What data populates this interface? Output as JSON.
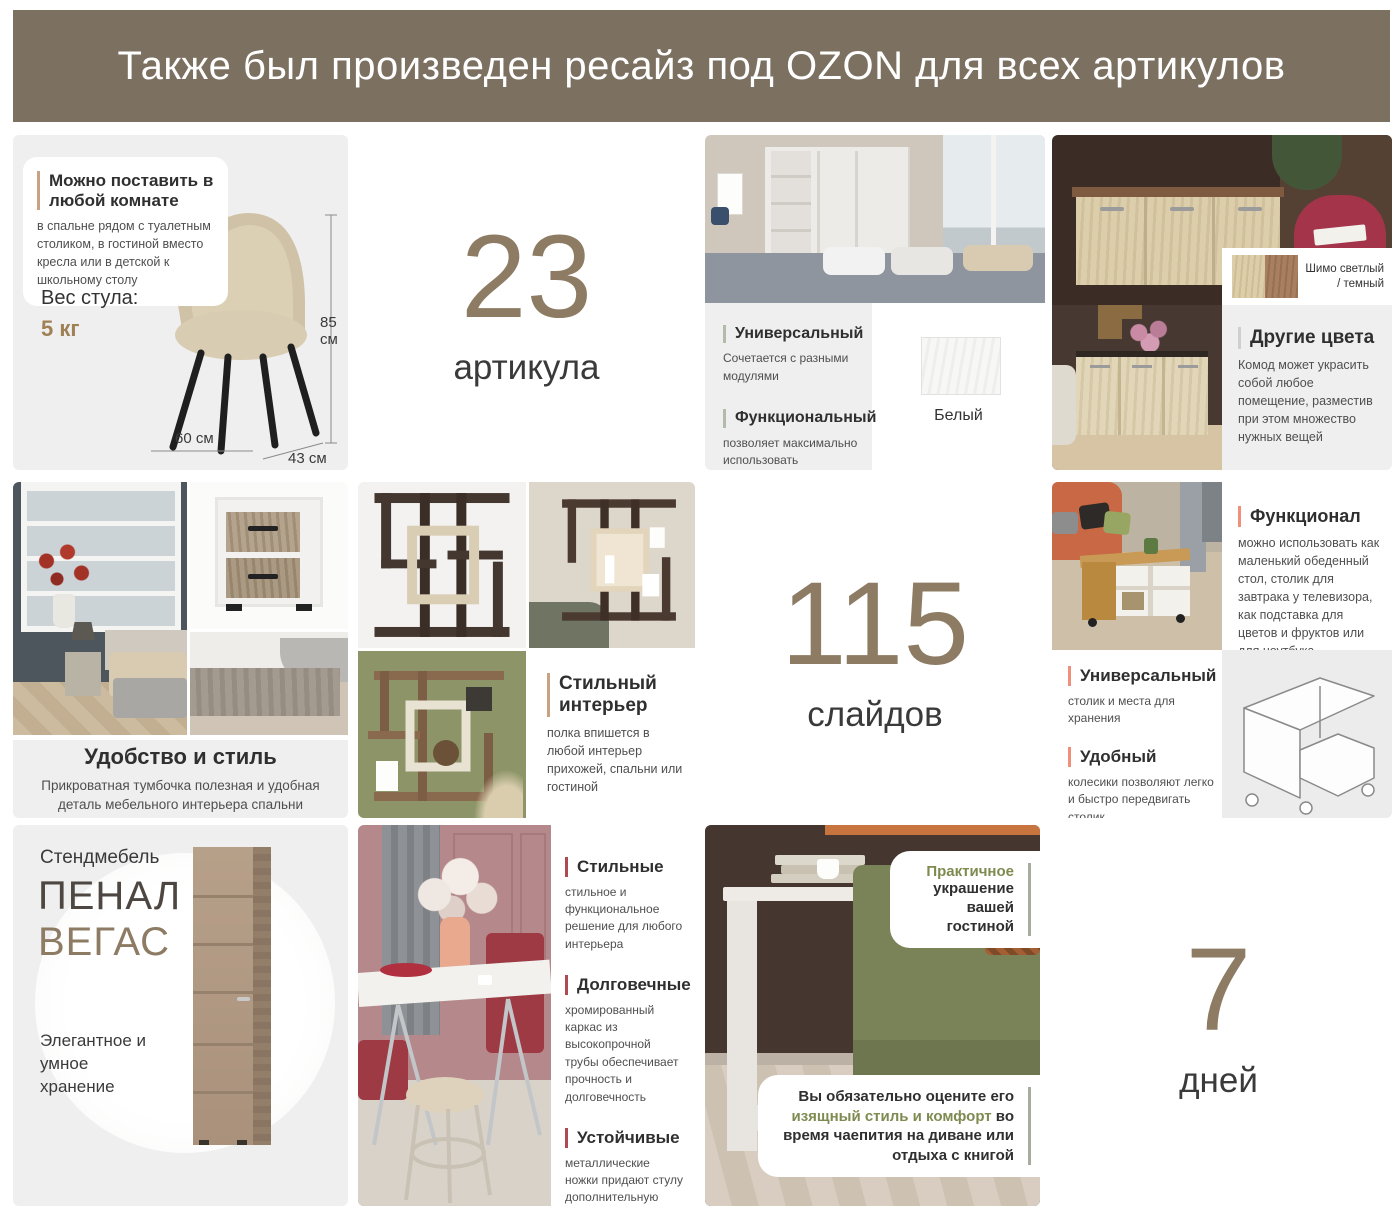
{
  "header": {
    "title": "Также был произведен ресайз под OZON для всех артикулов"
  },
  "stats": {
    "articles": {
      "value": "23",
      "label": "артикула"
    },
    "slides": {
      "value": "115",
      "label": "слайдов"
    },
    "days": {
      "value": "7",
      "label": "дней"
    }
  },
  "chair_card": {
    "feature_title": "Можно поставить в любой комнате",
    "feature_body": "в спальне рядом с туалетным столиком, в гостиной вместо кресла или в детской к школьному столу",
    "weight_label": "Вес стула:",
    "weight_value": "5 кг",
    "dims": {
      "height_num": "85",
      "height_unit": "см",
      "width": "60 см",
      "depth": "43 см"
    }
  },
  "wardrobe_card": {
    "features": [
      {
        "title": "Универсальный",
        "body": "Сочетается с разными модулями"
      },
      {
        "title": "Функциональный",
        "body": "позволяет максимально использовать пространство в комнате"
      }
    ],
    "swatch_label": "Белый"
  },
  "dresser_card": {
    "swatch_label": "Шимо светлый / темный",
    "feature_title": "Другие цвета",
    "feature_body": "Комод может украсить собой любое помещение, разместив при этом множество нужных вещей"
  },
  "nightstand_card": {
    "title": "Удобство и стиль",
    "body": "Прикроватная тумбочка полезная и удобная деталь мебельного интерьера спальни"
  },
  "shelf_card": {
    "feature_title": "Стильный интерьер",
    "feature_body": "полка впишется в любой интерьер прихожей, спальни или гостиной"
  },
  "coffee_table_card": {
    "features": [
      {
        "title": "Функционал",
        "body": "можно использовать как маленький обеденный стол, столик для завтрака у телевизора, как подставка для цветов и фруктов или для ноутбука"
      },
      {
        "title": "Универсальный",
        "body": "столик и места для хранения"
      },
      {
        "title": "Удобный",
        "body": "колесики позволяют легко и быстро передвигать столик"
      }
    ]
  },
  "penal_card": {
    "brand": "Стендмебель",
    "title_line1": "ПЕНАЛ",
    "title_line2": "ВЕГАС",
    "body": "Элегантное и умное хранение"
  },
  "dining_card": {
    "features": [
      {
        "title": "Стильные",
        "body": "стильное и функциональное решение для любого интерьера"
      },
      {
        "title": "Долговечные",
        "body": "хромированный каркас из высокопрочной трубы обеспечивает прочность и долговечность"
      },
      {
        "title": "Устойчивые",
        "body": "металлические ножки придают стулу дополнительную надежность и практичность"
      }
    ]
  },
  "sofa_card": {
    "callout_top": {
      "highlight": "Практичное",
      "rest": "украшение вашей гостиной"
    },
    "callout_bottom": {
      "part1": "Вы обязательно оцените его ",
      "highlight": "изящный стиль и комфорт",
      "part2": " во время чаепития на диване или отдыха с книгой"
    }
  },
  "colors": {
    "header_bg": "#7c7060",
    "card_bg": "#efefef",
    "accent_number": "#8d7c63",
    "tan_bar": "#c9a283",
    "sage_bar": "#b2bcaa",
    "salmon_bar": "#f0907a",
    "red_bar": "#b04a52",
    "gray_bar": "#cfcfcf",
    "green_text": "#7d8b50",
    "brown_text": "#a08055"
  }
}
